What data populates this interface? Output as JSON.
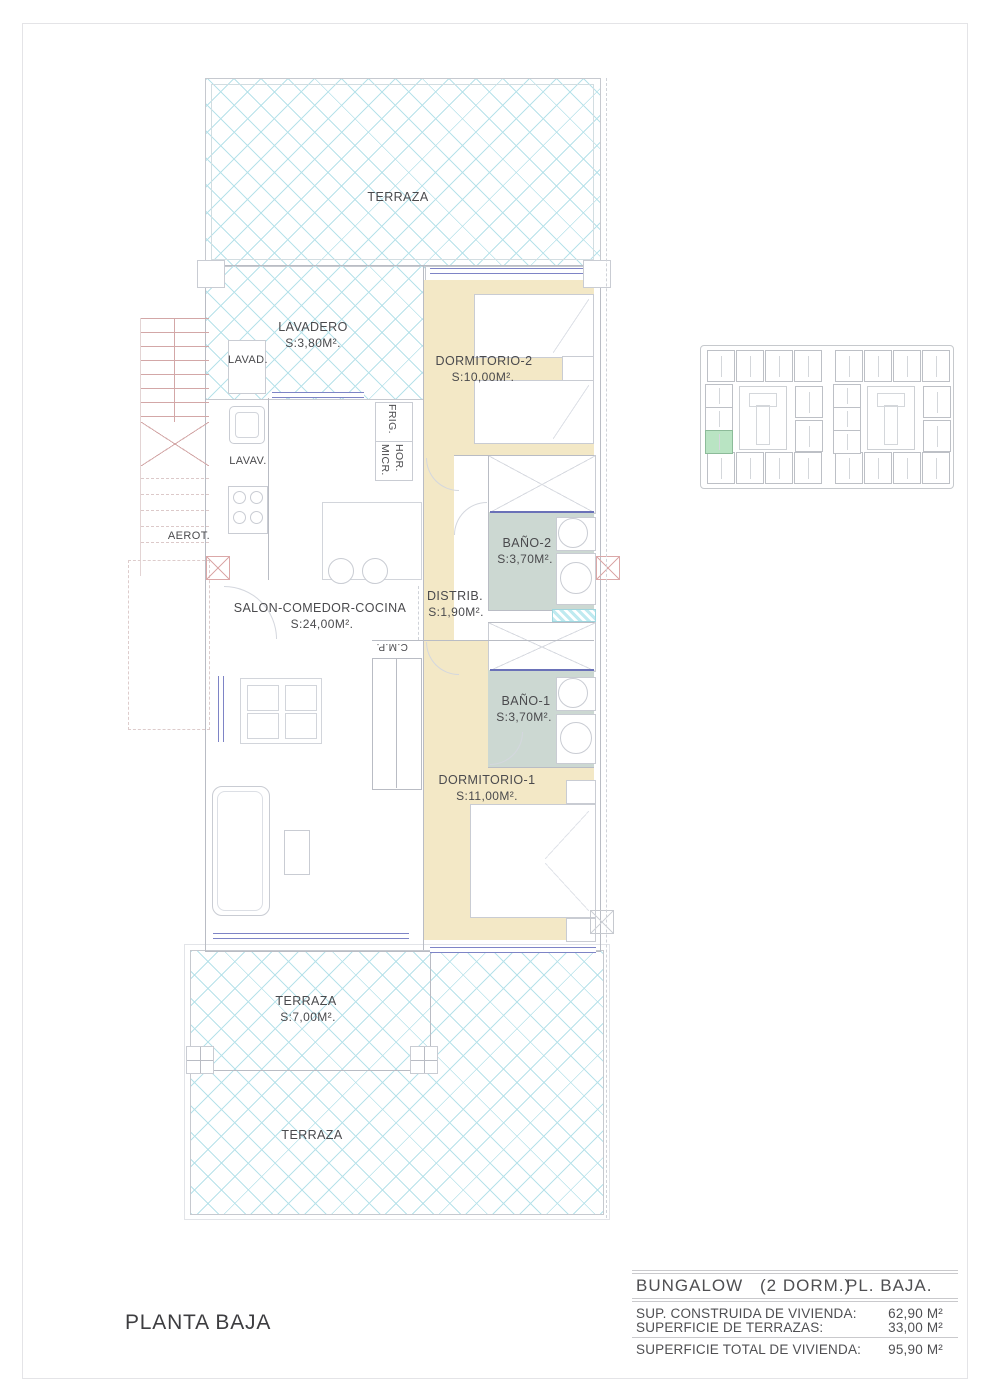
{
  "sheet": {
    "plan_title": "PLANTA BAJA"
  },
  "labels": {
    "terraza_top": "TERRAZA",
    "lavadero_name": "LAVADERO",
    "lavadero_area": "S:3,80M².",
    "lavad": "LAVAD.",
    "lavav": "LAVAV.",
    "aerot": "AEROT.",
    "frig": "FRIG.",
    "hor": "HOR.",
    "micr": "MICR.",
    "dormitorio2_name": "DORMITORIO-2",
    "dormitorio2_area": "S:10,00M².",
    "bano2_name": "BAÑO-2",
    "bano2_area": "S:3,70M².",
    "distrib_name": "DISTRIB.",
    "distrib_area": "S:1,90M².",
    "salon_name": "SALON-COMEDOR-COCINA",
    "salon_area": "S:24,00M².",
    "cmp": "C.M.P.",
    "bano1_name": "BAÑO-1",
    "bano1_area": "S:3,70M².",
    "dormitorio1_name": "DORMITORIO-1",
    "dormitorio1_area": "S:11,00M².",
    "terraza_mid_name": "TERRAZA",
    "terraza_mid_area": "S:7,00M².",
    "terraza_bottom": "TERRAZA"
  },
  "title_block": {
    "product": "BUNGALOW",
    "variant": "(2 DORM.)",
    "floor": "PL. BAJA.",
    "rows": [
      {
        "label": "SUP. CONSTRUIDA DE VIVIENDA:",
        "value": "62,90 M²"
      },
      {
        "label": "SUPERFICIE DE TERRAZAS:",
        "value": "33,00 M²"
      },
      {
        "label": "SUPERFICIE TOTAL DE VIVIENDA:",
        "value": "95,90 M²"
      }
    ]
  },
  "key_plan": {
    "highlight_color": "#b9e4c3",
    "cluster_count": 2,
    "top_units": 4,
    "bottom_units": 4,
    "left_units": 3,
    "right_units": 2,
    "highlighted_unit": {
      "cluster": 0,
      "column": "left",
      "index": 2
    }
  },
  "stairs": {
    "treads_solid": 8,
    "treads_dashed": 5
  },
  "colors": {
    "room_cream": "#f3e8c6",
    "bath_sage": "#ccd8d2",
    "hatch_cyan": "#b7e2ea",
    "window_blue": "#7e84c6",
    "stair_red": "#d3a7a7",
    "wall_gray": "#b9bcc4",
    "text_gray": "#4a4a4d",
    "keyplan_highlight": "#b9e4c3"
  }
}
